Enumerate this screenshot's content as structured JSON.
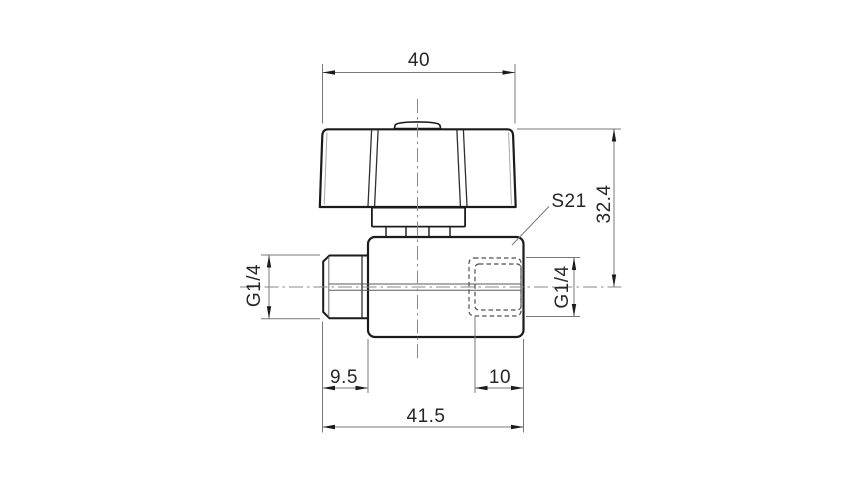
{
  "drawing": {
    "labels": {
      "dim_handle_width": "40",
      "dim_overall_height": "32.4",
      "label_wrench_size": "S21",
      "dim_thread_male": "G1/4",
      "dim_thread_female": "G1/4",
      "dim_male_thread_length": "9.5",
      "dim_thread_depth": "10",
      "dim_overall_length": "41.5"
    },
    "colors": {
      "background": "#ffffff",
      "outline": "#1b1b1b",
      "dimension_lines": "#787878",
      "hidden_lines": "#4f4f4f",
      "centerlines": "#8a8a8a",
      "text": "#262626"
    }
  }
}
